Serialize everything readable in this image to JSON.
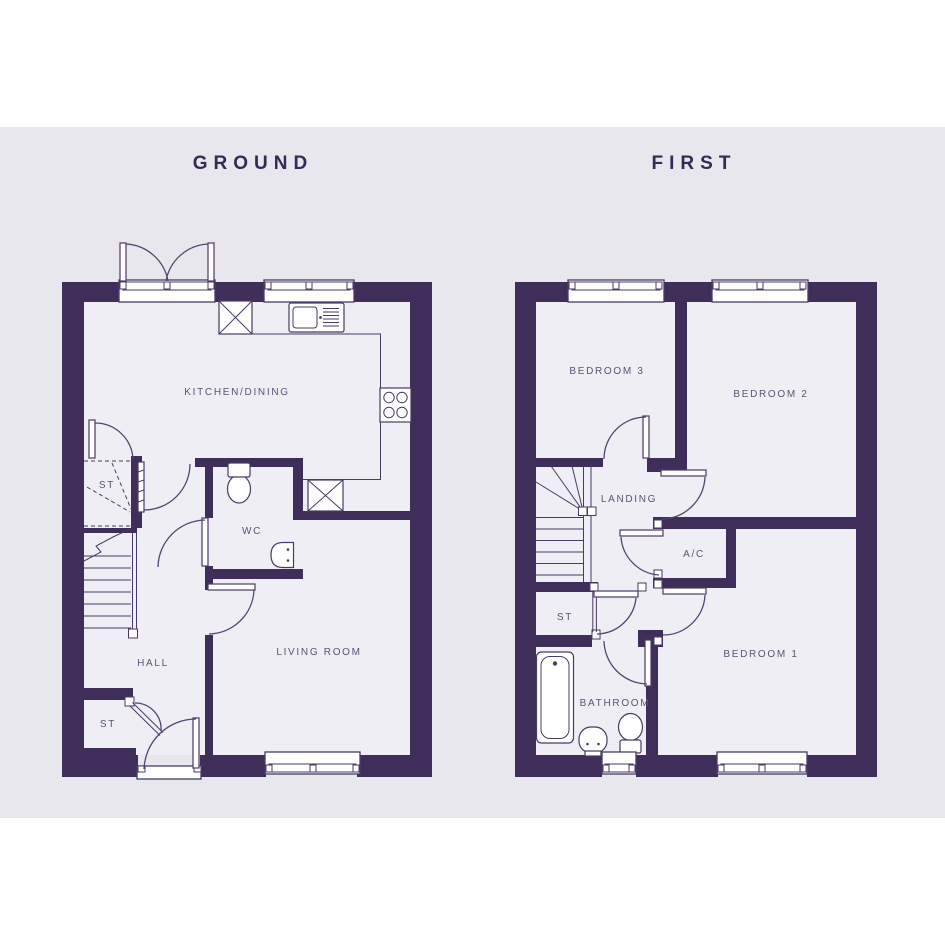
{
  "page": {
    "background": "#ffffff",
    "band_background": "#e9e7ee",
    "type": "house-floorplan"
  },
  "colors": {
    "wall": "#3f2e5a",
    "line": "#4a3a66",
    "arc": "#54446f",
    "label_text": "#5b5374",
    "title_text": "#372a52",
    "room_interior": "#efeef4",
    "fixture_fill": "#ffffff"
  },
  "floors": [
    {
      "id": "ground",
      "title": "GROUND",
      "rooms": [
        {
          "name": "KITCHEN/DINING"
        },
        {
          "name": "ST"
        },
        {
          "name": "WC"
        },
        {
          "name": "HALL"
        },
        {
          "name": "LIVING ROOM"
        },
        {
          "name": "ST"
        }
      ],
      "fixtures": [
        "french-doors",
        "kitchen-window",
        "appliance-box",
        "kitchen-sink",
        "hob",
        "appliance-box",
        "toilet",
        "hand-basin",
        "stairs",
        "front-door",
        "living-room-window"
      ]
    },
    {
      "id": "first",
      "title": "FIRST",
      "rooms": [
        {
          "name": "BEDROOM 3"
        },
        {
          "name": "BEDROOM 2"
        },
        {
          "name": "LANDING"
        },
        {
          "name": "A/C"
        },
        {
          "name": "ST"
        },
        {
          "name": "BATHROOM"
        },
        {
          "name": "BEDROOM 1"
        }
      ],
      "fixtures": [
        "bedroom3-window",
        "bedroom2-window",
        "stairs",
        "bath",
        "pedestal-basin",
        "toilet",
        "bathroom-window",
        "bedroom1-window"
      ]
    }
  ]
}
